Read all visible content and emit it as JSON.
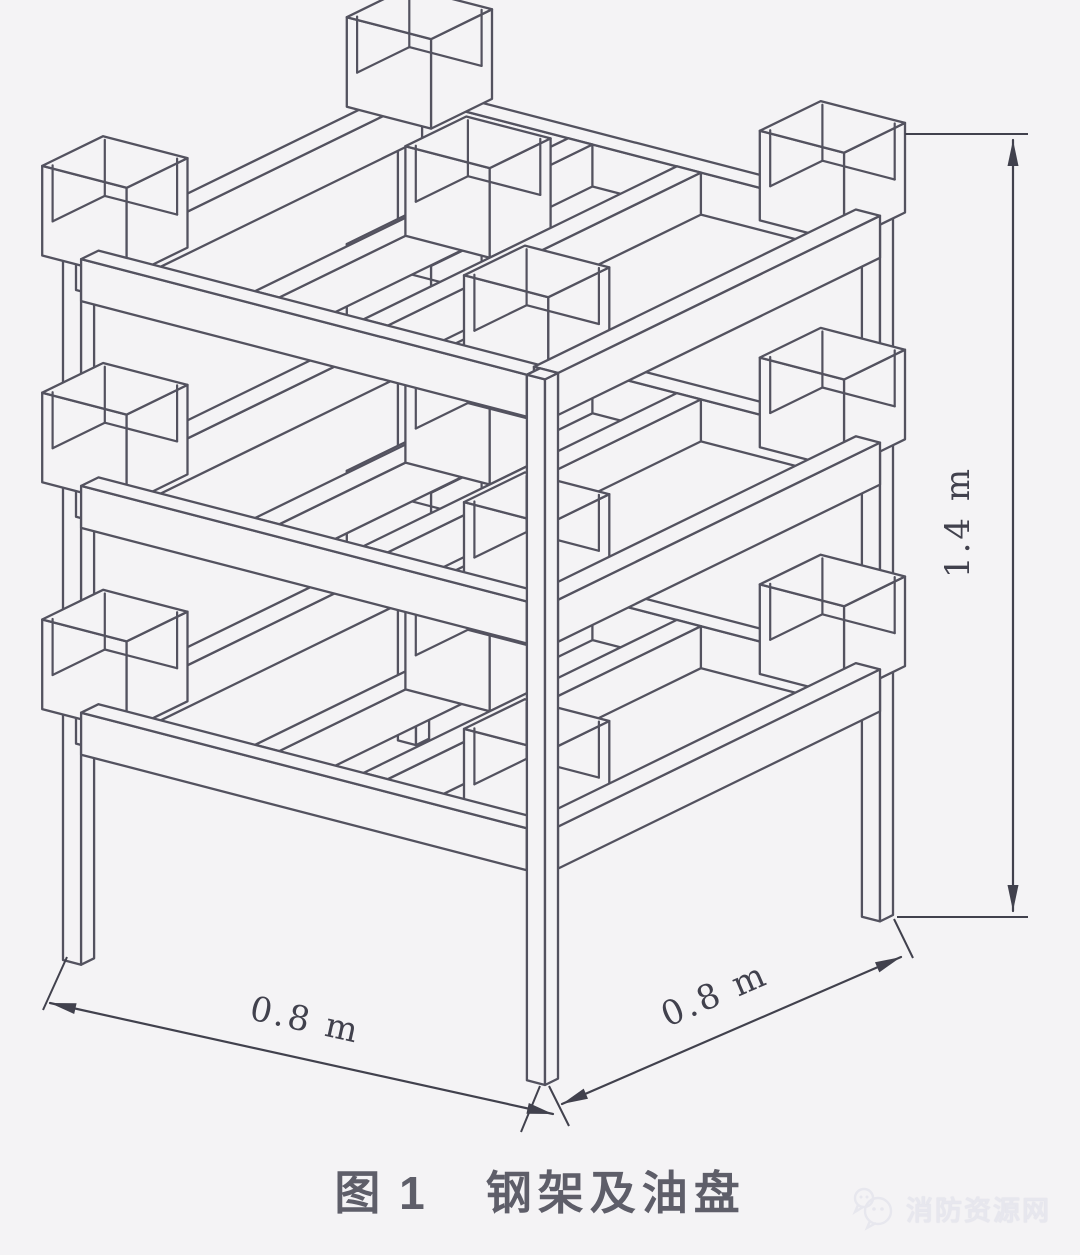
{
  "page": {
    "background": "#f4f3f5"
  },
  "figure": {
    "caption": {
      "prefix": "图 1",
      "title": "钢架及油盘"
    },
    "dims": {
      "base_left": "0.8 m",
      "base_right": "0.8 m",
      "height": "1.4 m"
    },
    "watermark": {
      "name": "消防资源网"
    },
    "style": {
      "line": "#53525f",
      "dim_text": "#41414d",
      "caption_color": "#5e5e69",
      "watermark_color": "#e7e7ee",
      "paper": "#f4f3f5"
    },
    "scene": {
      "kind": "three-tier steel frame with oil pans",
      "footprint_m": 0.8,
      "height_m": 1.4,
      "tiers_z": [
        0.45,
        0.855,
        1.26
      ],
      "rail": {
        "h": 0.075
      },
      "post": {
        "w": 0.03,
        "top": 1.26
      },
      "pan": {
        "size": 0.14,
        "height": 0.16,
        "inset": 0.01,
        "cavity": 0.1
      },
      "pans_per_tier": 5,
      "posts": 4
    }
  }
}
